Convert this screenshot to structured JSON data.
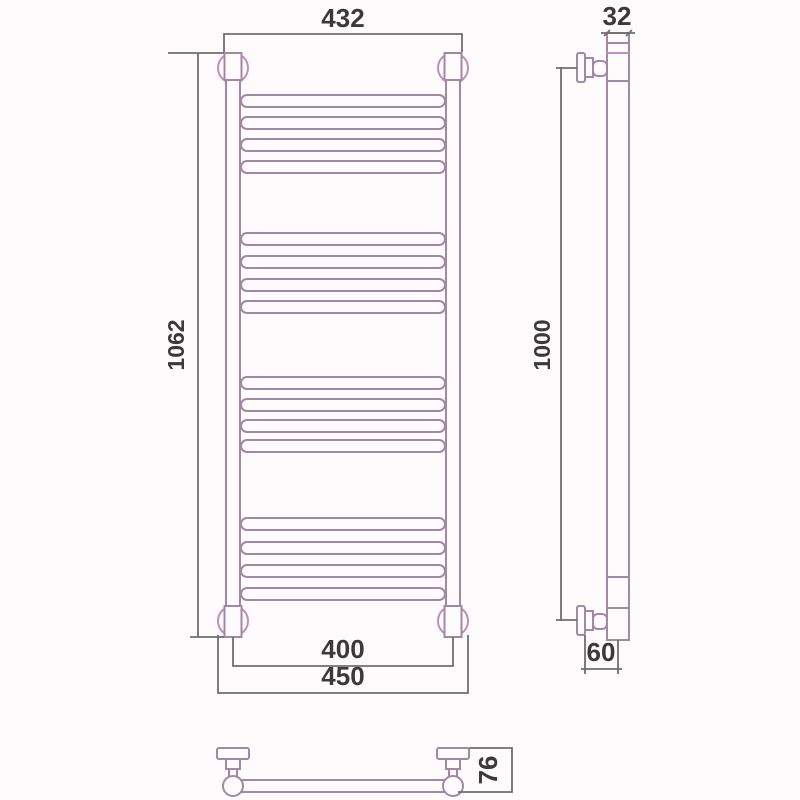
{
  "title": "Ladder towel radiator dimensional drawing",
  "views": {
    "front": {
      "name": "front view",
      "dim_top_width": "432",
      "dim_height": "1062",
      "dim_bottom_axis_width": "400",
      "dim_bottom_outer_width": "450",
      "rung_groups": 4,
      "rungs_per_group": 4
    },
    "side": {
      "name": "side view",
      "dim_tube_width": "32",
      "dim_mount_spacing": "1000",
      "dim_wall_offset": "60"
    },
    "bottom": {
      "name": "bottom view",
      "dim_depth": "76"
    }
  },
  "colors": {
    "body_line": "#a287a6",
    "bracket_accent": "#c38cc3",
    "dimension_line": "#6f6f6f",
    "dimension_text": "#3a3a3a",
    "background": "#fdfbfc"
  }
}
